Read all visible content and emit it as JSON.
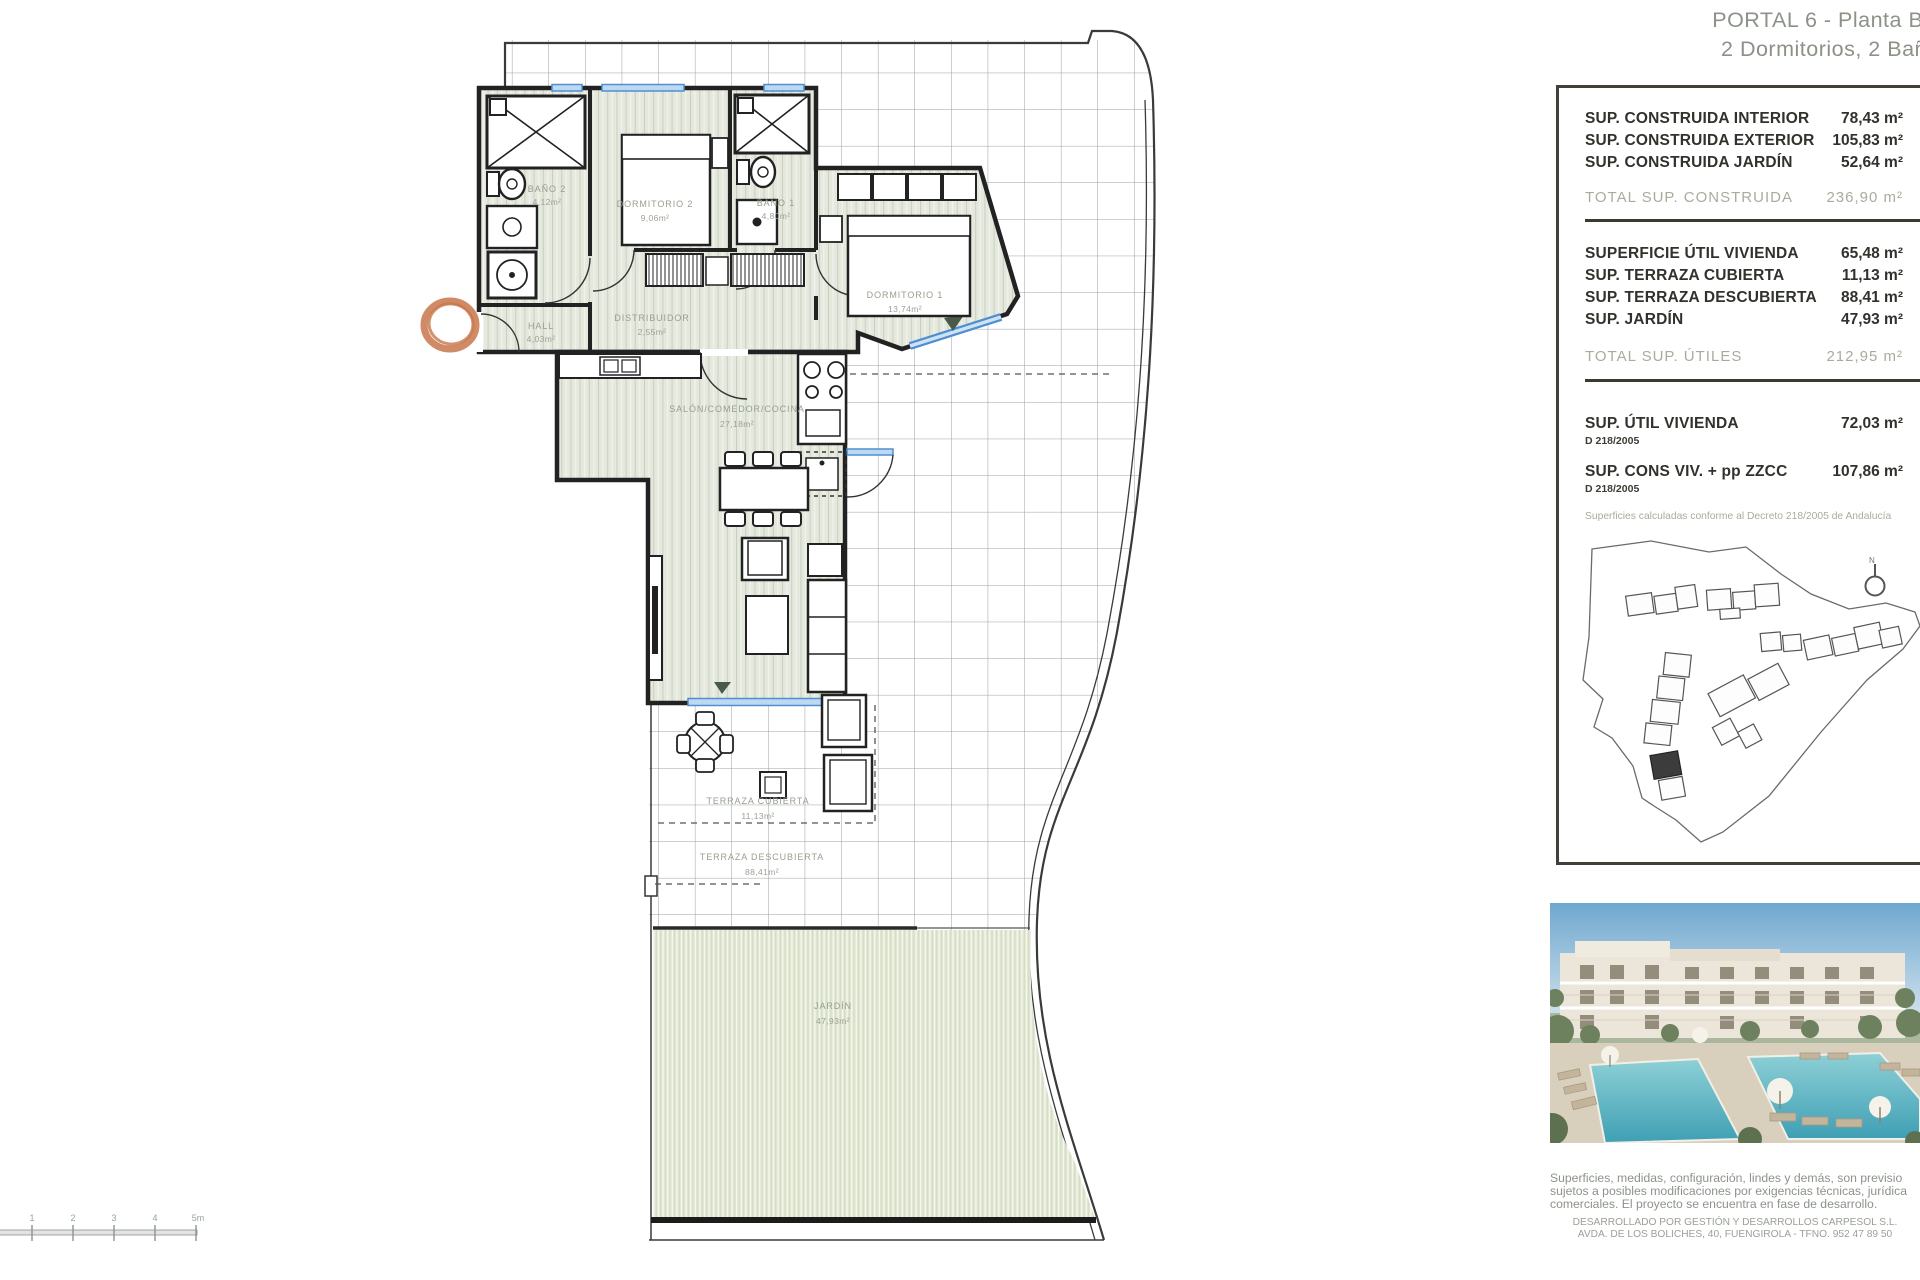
{
  "title": {
    "line1": "PORTAL 6 - Planta Ba",
    "line2": "2 Dormitorios, 2 Bañ"
  },
  "table": {
    "construida": {
      "rows": [
        {
          "label": "SUP. CONSTRUIDA INTERIOR",
          "value": "78,43 m²"
        },
        {
          "label": "SUP. CONSTRUIDA EXTERIOR",
          "value": "105,83 m²"
        },
        {
          "label": "SUP. CONSTRUIDA JARDÍN",
          "value": "52,64 m²"
        }
      ],
      "total": {
        "label": "TOTAL SUP. CONSTRUIDA",
        "value": "236,90 m²"
      }
    },
    "utiles": {
      "rows": [
        {
          "label": "SUPERFICIE ÚTIL VIVIENDA",
          "value": "65,48 m²"
        },
        {
          "label": "SUP. TERRAZA CUBIERTA",
          "value": "11,13 m²"
        },
        {
          "label": "SUP. TERRAZA DESCUBIERTA",
          "value": "88,41 m²"
        },
        {
          "label": "SUP. JARDÍN",
          "value": "47,93 m²"
        }
      ],
      "total": {
        "label": "TOTAL SUP. ÚTILES",
        "value": "212,95 m²"
      }
    },
    "decree": {
      "rows": [
        {
          "label": "SUP. ÚTIL VIVIENDA",
          "sub": "D 218/2005",
          "value": "72,03 m²"
        },
        {
          "label": "SUP. CONS VIV. + pp ZZCC",
          "sub": "D 218/2005",
          "value": "107,86 m²"
        }
      ],
      "note": "Superficies calculadas conforme al Decreto 218/2005 de Andalucía"
    }
  },
  "plan": {
    "rooms": {
      "bano2": {
        "name": "BAÑO 2",
        "area": "4,12m²"
      },
      "dorm2": {
        "name": "DORMITORIO 2",
        "area": "9,06m²"
      },
      "bano1": {
        "name": "BAÑO 1",
        "area": "4,80m²"
      },
      "hall": {
        "name": "HALL",
        "area": "4,03m²"
      },
      "distribuidor": {
        "name": "DISTRIBUIDOR",
        "area": "2,55m²"
      },
      "dorm1": {
        "name": "DORMITORIO 1",
        "area": "13,74m²"
      },
      "salon": {
        "name": "SALÓN/COMEDOR/COCINA",
        "area": "27,18m²"
      },
      "terr_cub": {
        "name": "TERRAZA CUBIERTA",
        "area": "11,13m²"
      },
      "terr_desc": {
        "name": "TERRAZA DESCUBIERTA",
        "area": "88,41m²"
      },
      "jardin": {
        "name": "JARDÍN",
        "area": "47,93m²"
      }
    },
    "scale_ticks": [
      "1",
      "2",
      "3",
      "4",
      "5m"
    ],
    "compass": "N"
  },
  "footer": {
    "line1": "Superficies, medidas, configuración, lindes y demás, son previsio",
    "line2": "sujetos a posibles modificaciones por exigencias técnicas, jurídica",
    "line3": "comerciales. El proyecto se encuentra en fase de desarrollo.",
    "dev1": "DESARROLLADO POR GESTIÓN Y DESARROLLOS CARPESOL S.L.",
    "dev2": "AVDA. DE LOS BOLICHES, 40, FUENGIROLA - TFNO. 952 47 89 50"
  },
  "colors": {
    "wall": "#222222",
    "window_blue": "#4f8fd0",
    "floor": "#e4e8dd",
    "garden": "#dfe6d0",
    "accent_orange": "#c8764a",
    "panel_border": "#3f4337",
    "muted_text": "#a7ad9e"
  }
}
